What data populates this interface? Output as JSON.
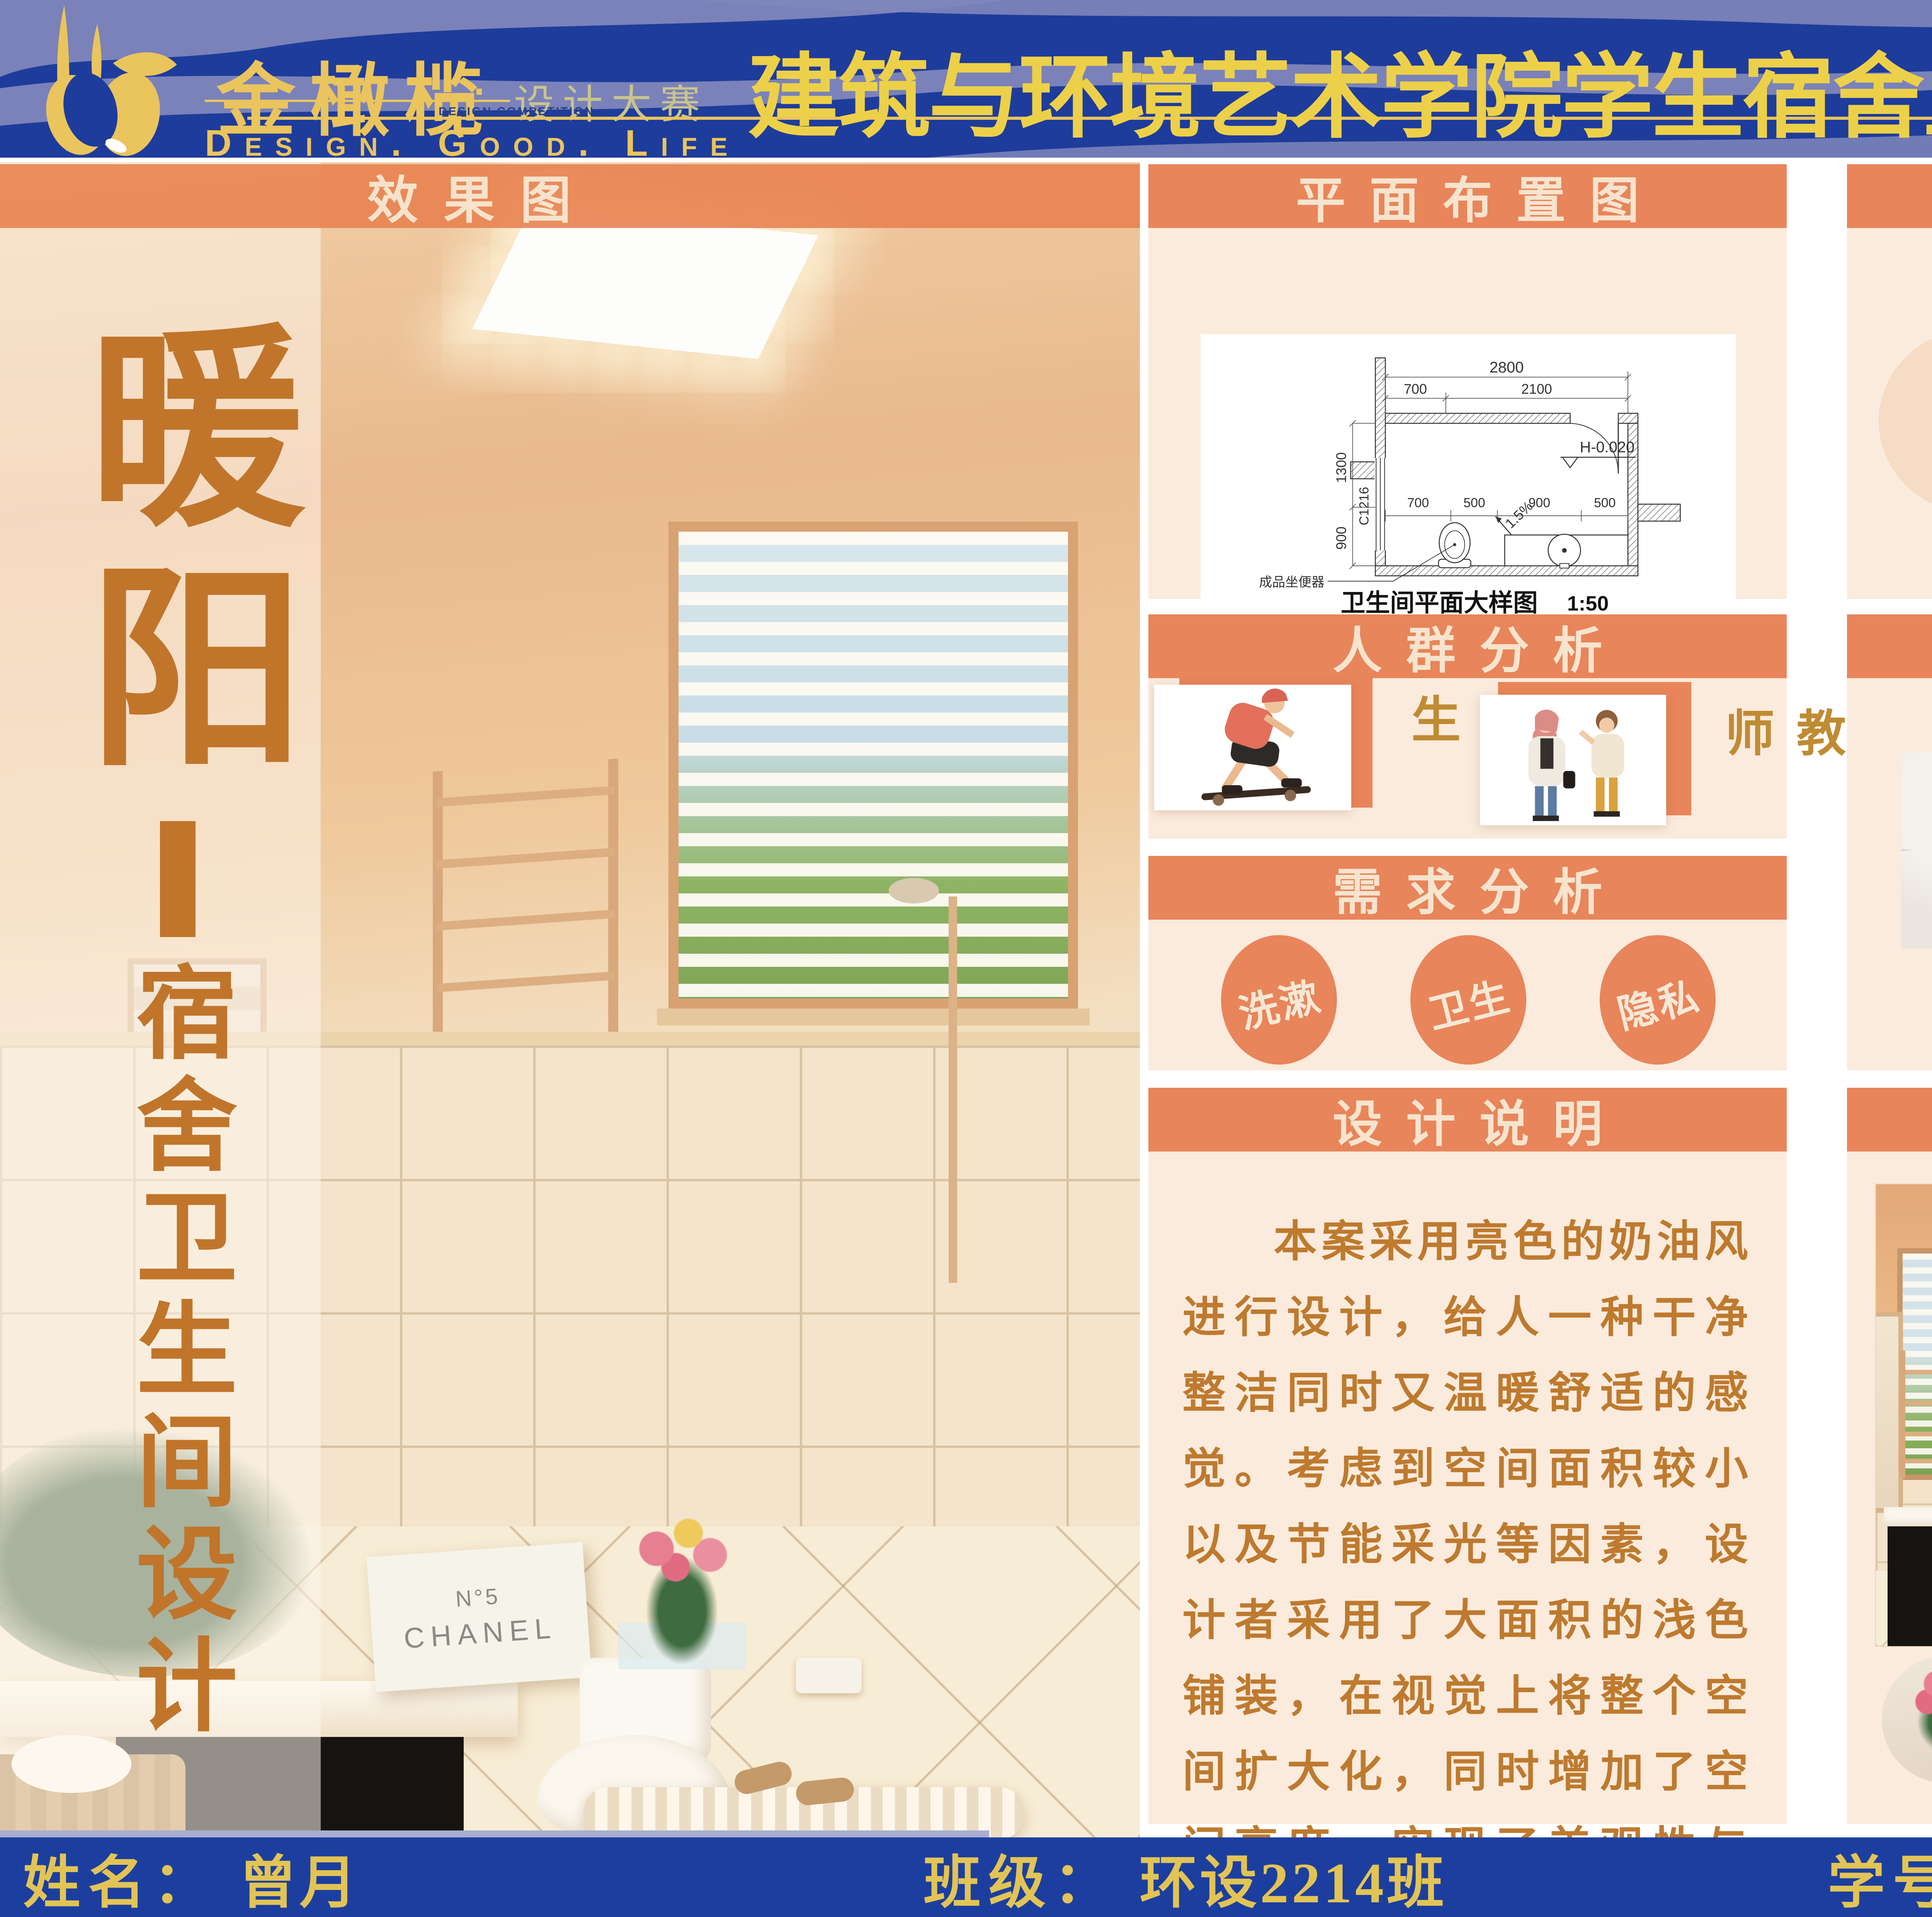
{
  "banner": {
    "logo": {
      "name": "金橄榄",
      "dot": "·",
      "sub": "设计大赛",
      "sub_en": "DESIGN COMPETITION",
      "tagline": "Design.  Good.  Life"
    },
    "title": "建筑与环境艺术学院学生宿舍卫生间设计大赛"
  },
  "left_panel": {
    "header": "效果图",
    "title_main": "暖阳",
    "title_sub": "宿舍卫生间设计",
    "chanel_line1": "N°5",
    "chanel_line2": "CHANEL"
  },
  "plan": {
    "header": "平面布置图",
    "caption": "卫生间平面大样图",
    "scale": "1:50",
    "dim_total": "2800",
    "dim_left": "700",
    "dim_right": "2100",
    "dim_side_upper": "1300",
    "dim_side_lower": "900",
    "dims_inner": [
      "700",
      "500",
      "900",
      "500"
    ],
    "slope": "1.5%",
    "level": "H-0.020",
    "window": "C1216",
    "fixture_label": "成品坐便器"
  },
  "crowd": {
    "header": "人群分析",
    "items": [
      {
        "label": "学生"
      },
      {
        "label": "教师"
      }
    ]
  },
  "needs": {
    "header": "需求分析",
    "items": [
      {
        "label": "洗漱"
      },
      {
        "label": "卫生"
      },
      {
        "label": "隐私"
      }
    ]
  },
  "description": {
    "header": "设计说明",
    "text": "本案采用亮色的奶油风进行设计，给人一种干净整洁同时又温暖舒适的感觉。考虑到空间面积较小以及节能采光等因素，设计者采用了大面积的浅色铺装，在视觉上将整个空间扩大化，同时增加了空间亮度，实现了美观性与实用性的统一。"
  },
  "colors": {
    "header": "颜色分析图",
    "swatches": [
      "#F6DCC4",
      "#DBAE85",
      "#B79C7E"
    ]
  },
  "materials": {
    "header": "材质分析图",
    "items": [
      {
        "label": "瓷砖"
      },
      {
        "label": "大理石"
      },
      {
        "label": "乳胶漆"
      }
    ]
  },
  "renders": {
    "header": "效果图"
  },
  "footer": {
    "name_label": "姓名：",
    "name": "曾月",
    "class_label": "班级：",
    "class_value": "环设2214班",
    "id_label": "学号：",
    "id_value": "202240393"
  },
  "theme": {
    "banner_blue": "#1E3C9B",
    "wave": "#8086BB",
    "gold": "#EAC45D",
    "header_orange": "#E8855A",
    "body_cream": "#FAEBDD",
    "text_brown": "#BE7A2E",
    "label_gold": "#BF8B33",
    "calligraphy": "#C0752B",
    "footer_blue": "#1C3F9F",
    "footer_text": "#E2C456"
  }
}
